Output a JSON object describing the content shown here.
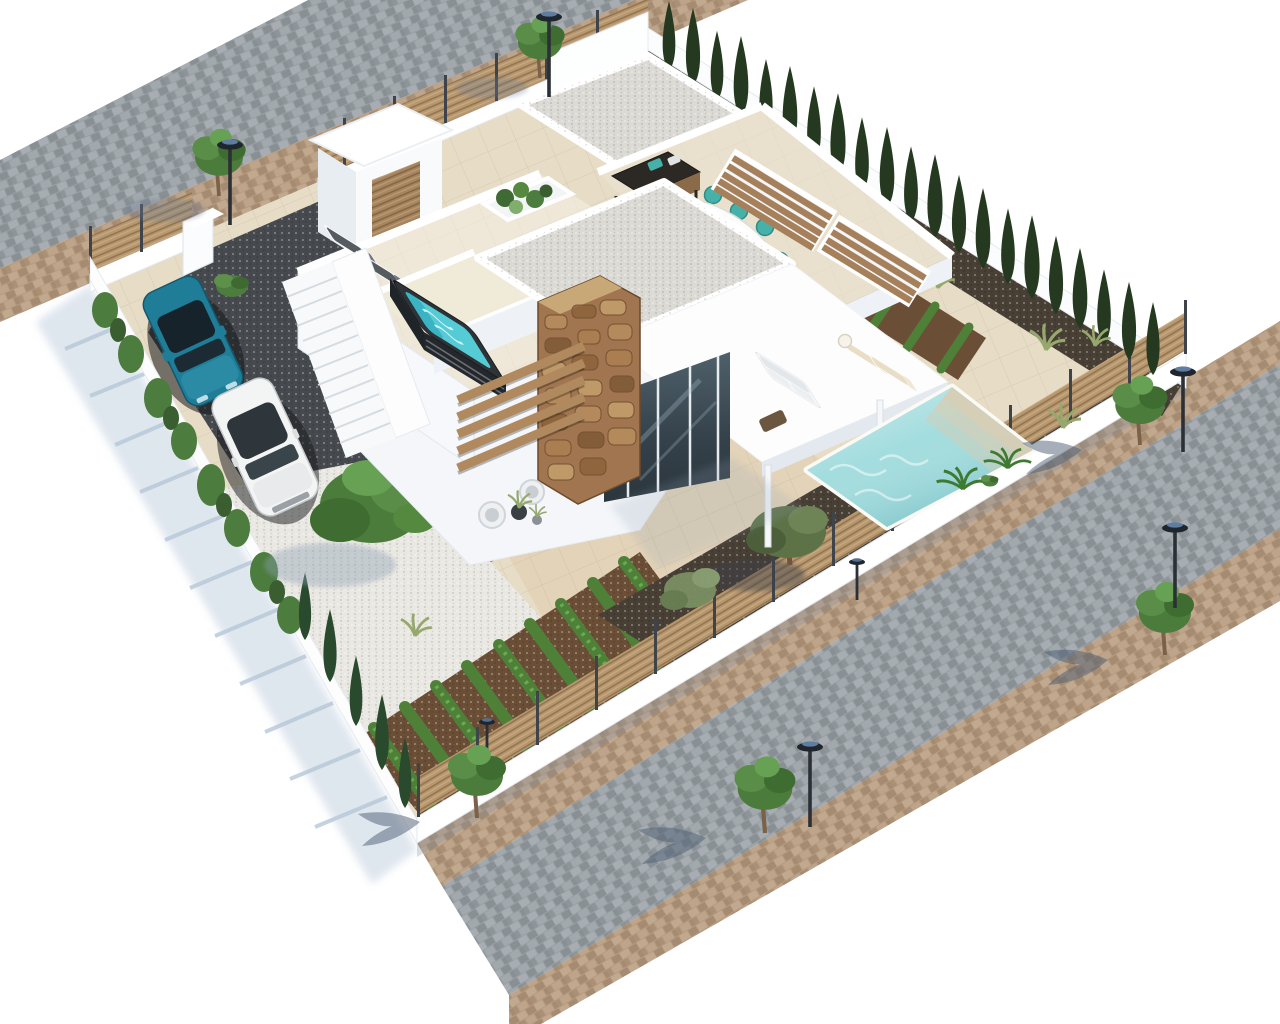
{
  "meta": {
    "kind": "3d-architectural-aerial-render",
    "subject": "Modern white flat-roof villa plot, isometric aerial view on white background",
    "visible_text": "none"
  },
  "scene": {
    "villa": {
      "storeys": 2,
      "features": [
        "white gravel flat roofs",
        "roof terrace with sun loungers",
        "hot tub terrace",
        "covered dining terrace",
        "rustic stone-clad column",
        "glass sliding doors",
        "wooden louvre stair",
        "white staircase from driveway",
        "entrance portal with wood door"
      ]
    },
    "pool": {
      "shape": "rectangular",
      "steps": 3,
      "loungers": 2,
      "side_table": 1
    },
    "dining": {
      "table": "white oval",
      "chairs": 8
    },
    "bbq_grill": 1,
    "jacuzzi": {
      "shell": "dark with wood slats",
      "water": "turquoise"
    },
    "parking": {
      "surface": "dark gravel",
      "cars": [
        {
          "type": "SUV",
          "color_name": "teal blue"
        },
        {
          "type": "SUV",
          "color_name": "white"
        }
      ]
    },
    "garden": {
      "vegetable_rows_front": 9,
      "vegetable_rows_back": 4,
      "white_gravel_bed": true,
      "olive_trees": 2,
      "big_tree": 1,
      "cypress_hedge_back_count": 21,
      "cypress_sw_count": 5,
      "hedge_bushes": 8,
      "louvre_planter_boxes": 2,
      "roof_shrub_balls": 5,
      "palms_by_pool": 2,
      "grass_tufts": 4
    },
    "street": {
      "road_paving": "grey cobblestone",
      "sidewalk_paving": "sand paver",
      "street_lamps": 5,
      "garden_lamps": 2,
      "street_trees": 6
    }
  },
  "colors": {
    "background": "#ffffff",
    "plot_tile": "#e7dcc6",
    "patio_tile": "#e3d3b8",
    "road_paver": "#b79b7e",
    "street_cobble": "#99a0a5",
    "wall_white": "#ffffff",
    "wall_shade": "#eef2f6",
    "shadow_blue": "#c6d3e0",
    "wood_fence": "#b9976c",
    "fence_post": "#3f444a",
    "hedge_green": "#4c7c3e",
    "cypress_dark": "#24391f",
    "gravel_white": "#eae8e2",
    "gravel_roof": "#dbdad5",
    "mulch": "#483f35",
    "soil": "#6b4e36",
    "veg_green": "#4e8038",
    "drive_gravel": "#46494d",
    "pool_water": "#9fdbdd",
    "pool_step": "#d8cdb4",
    "jacuzzi_water": "#55cbd6",
    "jacuzzi_shell": "#2e3338",
    "stone": "#a07550",
    "glass": "#3c4a54",
    "car_teal": "#1f7d98",
    "car_white": "#f3f4f4",
    "chair_teal": "#46b1a9",
    "lounger_gray": "#565b60",
    "lounger_beige": "#e9ddc5",
    "lamp_dark": "#22272d",
    "terrace_floor": "#efe8d8",
    "dining_floor": "#e9e1ce"
  }
}
